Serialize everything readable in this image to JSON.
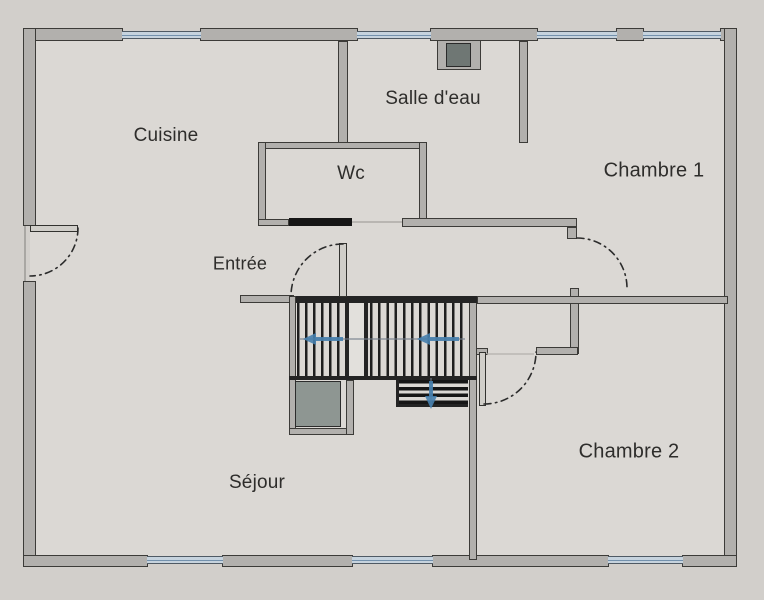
{
  "floorplan": {
    "rooms": {
      "cuisine": {
        "label": "Cuisine"
      },
      "salle_deau": {
        "label": "Salle d'eau"
      },
      "wc": {
        "label": "Wc"
      },
      "chambre1": {
        "label": "Chambre 1"
      },
      "entree": {
        "label": "Entrée"
      },
      "sejour": {
        "label": "Séjour"
      },
      "chambre2": {
        "label": "Chambre 2"
      }
    },
    "stairs": {
      "flights": 2,
      "direction_arrows": [
        "left",
        "left",
        "down"
      ]
    },
    "colors": {
      "background": "#d2cfcb",
      "floor": "#dbd8d4",
      "wall_fill": "#b2b0ad",
      "wall_outline": "#3c3b38",
      "window_pane": "#c6d3de",
      "window_frame": "#4f5a64",
      "window_line": "#7391ad",
      "door_dash": "#2b2b2b",
      "stair_arrow": "#4680ad",
      "duct_fill": "#8e9692",
      "chimney_fill": "#6f7774",
      "tread_dark": "#1e1e1e"
    }
  }
}
